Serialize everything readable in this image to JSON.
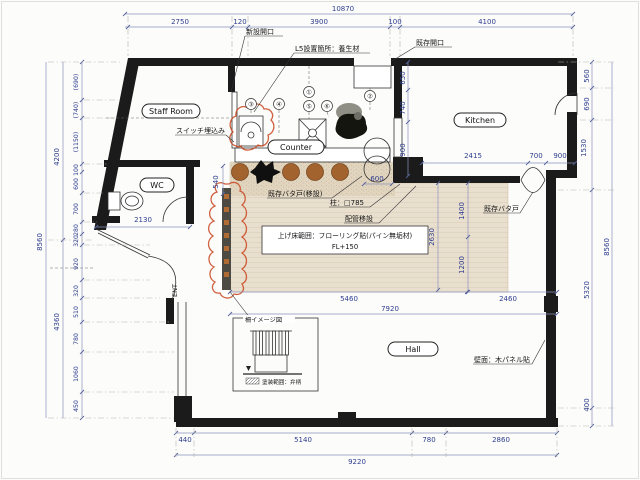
{
  "rooms": {
    "staff_room": "Staff Room",
    "wc": "WC",
    "kitchen": "Kitchen",
    "counter": "Counter",
    "hall": "Hall",
    "entrance": "ENT"
  },
  "annotations": {
    "new_opening": "新設開口",
    "l5_note": "L5設置箇所：養生材",
    "existing_opening": "既存開口",
    "switch_note": "スイッチ埋込み",
    "swing_door_relocated": "既存バタ戸(移設)",
    "column_note": "柱：□785",
    "pipe_note": "配管移設",
    "raised_floor_note": "上げ床範囲：フローリング貼(パイン無垢材)",
    "raised_floor_level": "FL+150",
    "existing_swing_door": "既存バタ戸",
    "wall_finish_note": "壁面：木パネル貼",
    "fence_title": "柵イメージ図",
    "fence_caption": "塗装範囲：弁柄"
  },
  "balloons": [
    "①",
    "②",
    "③",
    "④",
    "⑤",
    "⑥"
  ],
  "dimensions": {
    "top": {
      "overall": "10870",
      "segments": [
        "2750",
        "120",
        "3900",
        "100",
        "4100"
      ]
    },
    "bottom": {
      "overall": "9220",
      "segments": [
        "440",
        "5140",
        "780",
        "2860"
      ]
    },
    "left": {
      "overall": "8560",
      "upper": "4200",
      "lower": "4360",
      "segments": [
        "(690)",
        "(740)",
        "(1150)",
        "100",
        "600",
        "700",
        "280",
        "320",
        "920",
        "320",
        "510",
        "780",
        "1060",
        "450"
      ]
    },
    "right": {
      "overall": "8560",
      "segments": [
        "560",
        "690",
        "1530",
        "5320",
        "400"
      ]
    },
    "interior": {
      "kitchen_v1": "650",
      "kitchen_v2": "740",
      "kitchen_v3": "900",
      "kitchen_b1": "2415",
      "kitchen_b2": "700",
      "kitchen_b3": "900",
      "wc_width": "2130",
      "counter_depth": "540",
      "pass_width": "600",
      "hall_v1": "1400",
      "hall_v2": "1200",
      "hall_v3": "2630",
      "floor_w1": "5460",
      "floor_w2": "2460",
      "floor_total": "7920"
    }
  },
  "colors": {
    "wall": "#1b1b1b",
    "dimension_text": "#2e3d8f",
    "floor_fill": "#e9dfcf",
    "counter_band": "#e0d3bd",
    "stool": "#a2632f",
    "revision_cloud": "#c8451f",
    "fence_square": "#b06a33"
  }
}
